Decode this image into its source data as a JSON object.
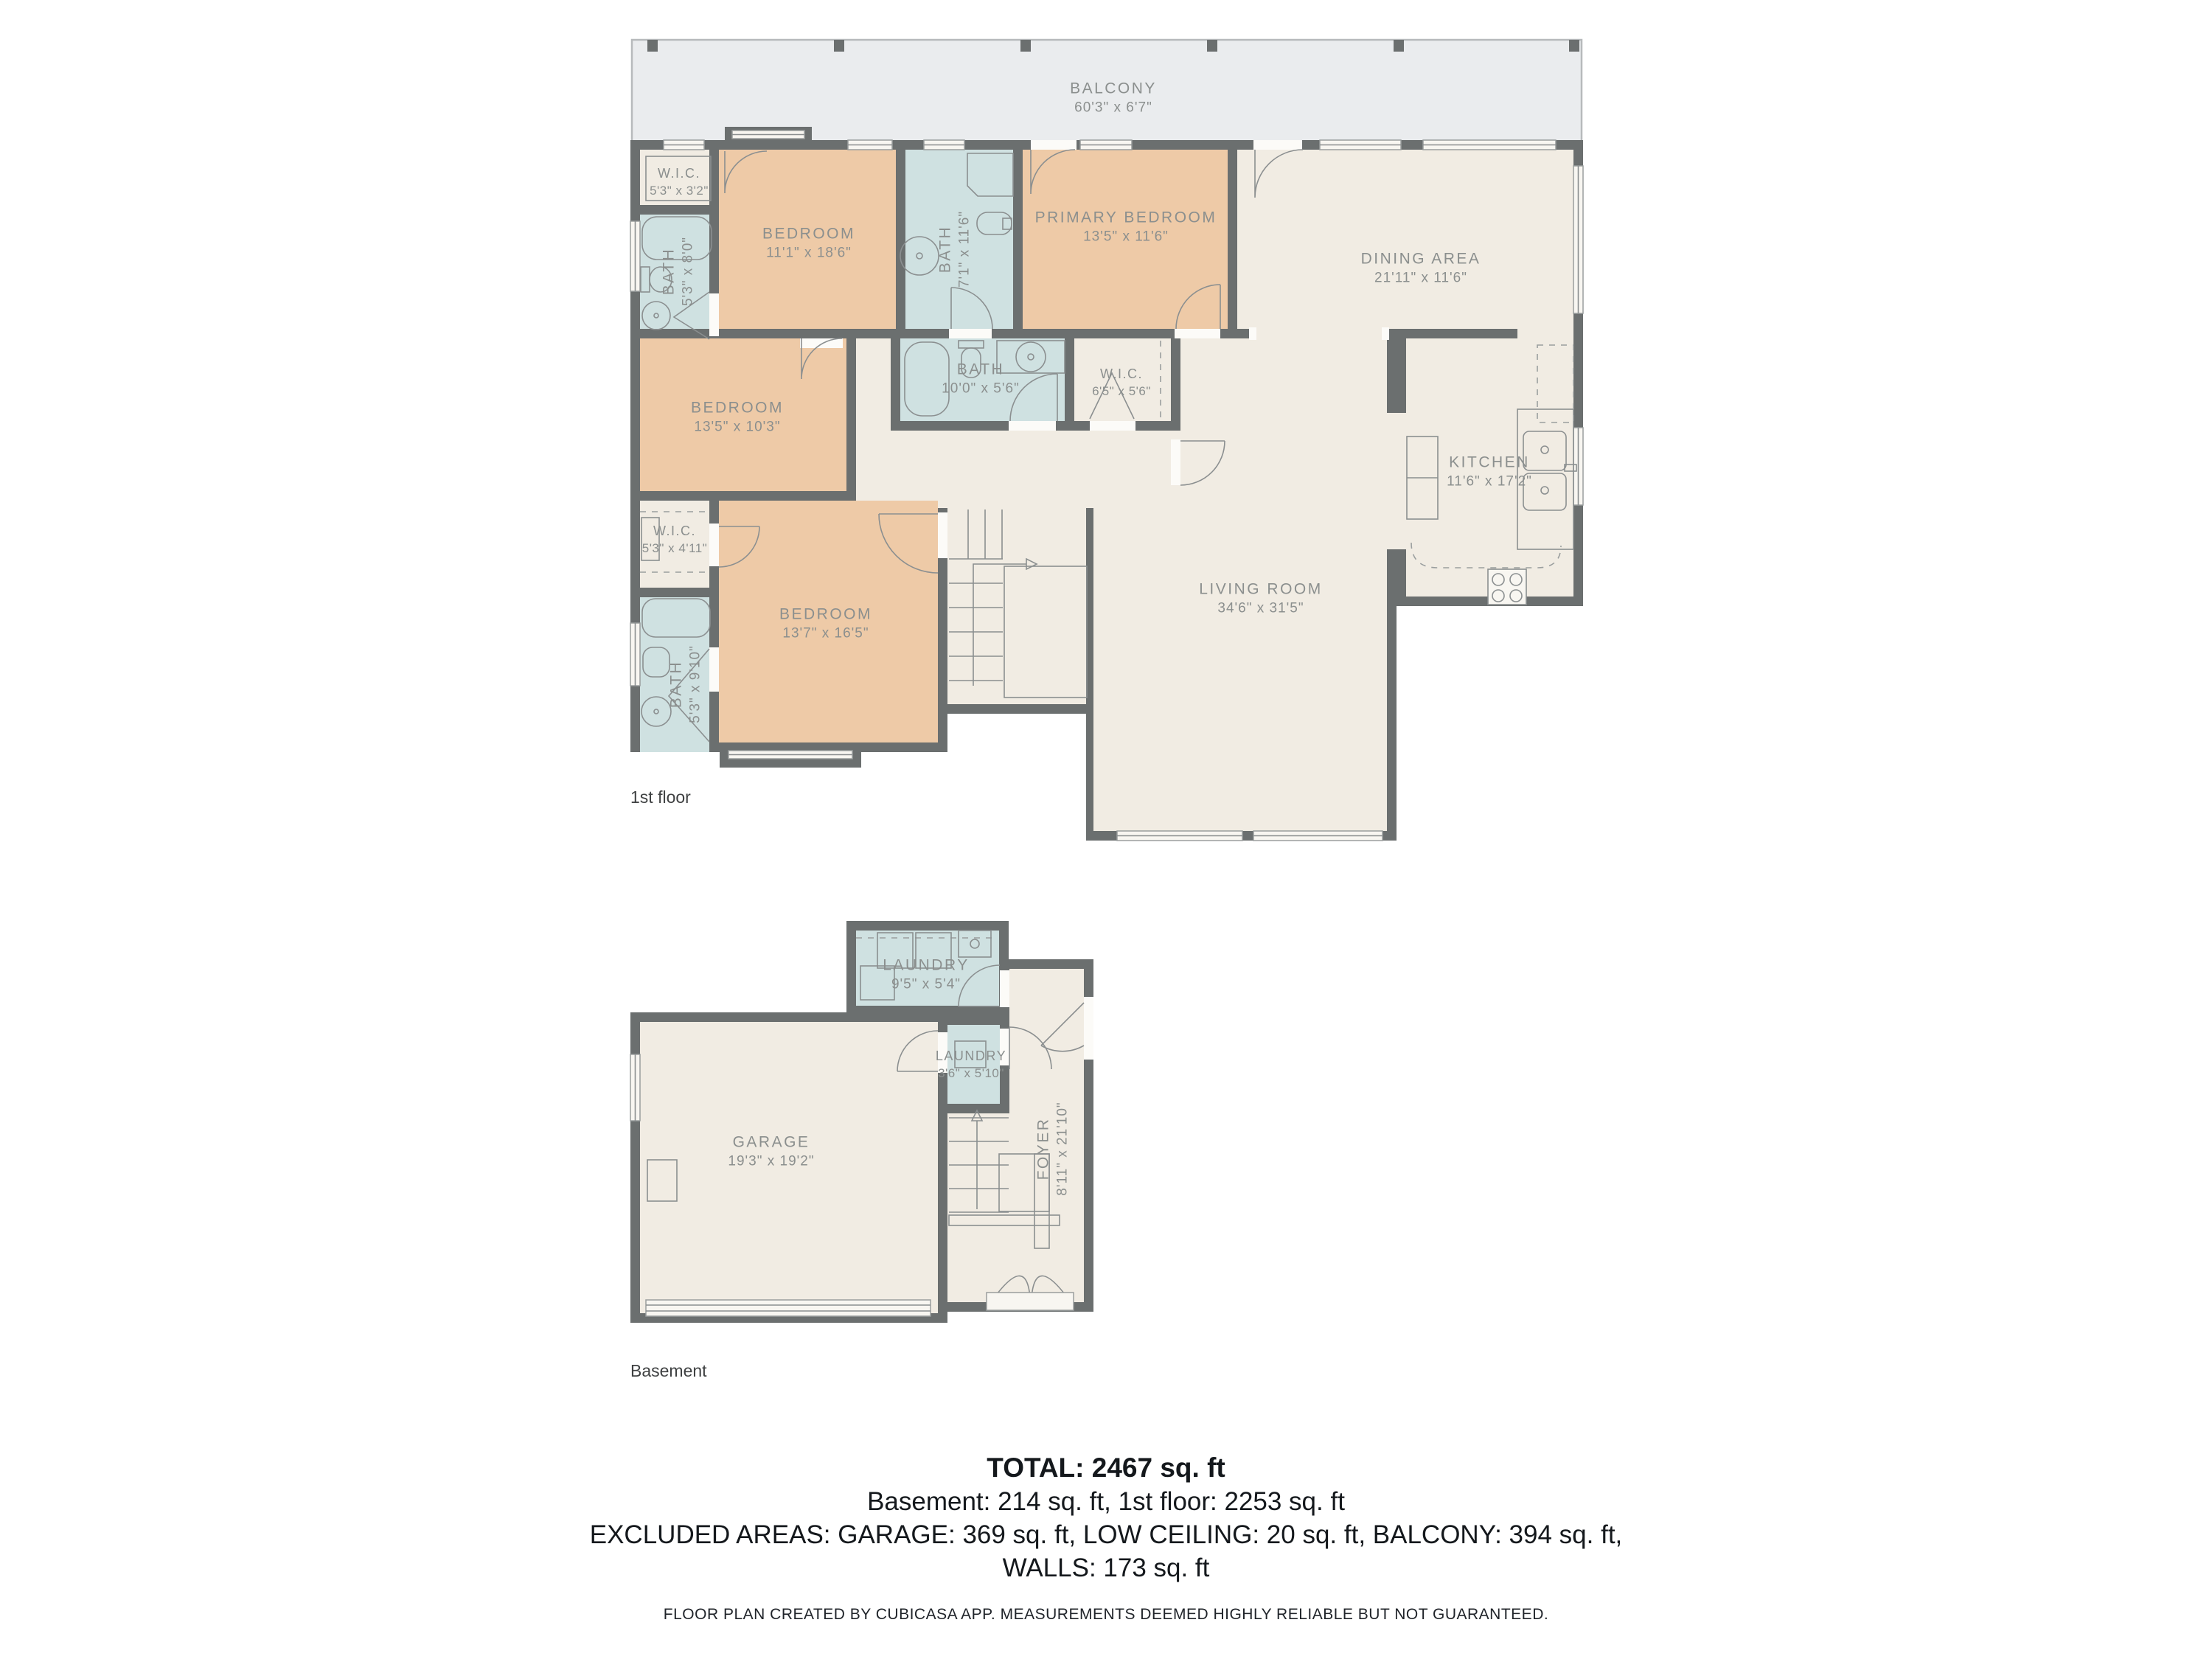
{
  "palette": {
    "wall": "#6b6f6f",
    "bedroom_fill": "#eecaa7",
    "wet_room_fill": "#cfe1e1",
    "common_fill": "#f1ece3",
    "balcony_fill": "#eaecee",
    "label_text": "#8b8f8e",
    "summary_text": "#14181c"
  },
  "floor1": {
    "tag": "1st floor",
    "rooms": [
      {
        "name": "BALCONY",
        "dims": "60'3\" x 6'7\""
      },
      {
        "name": "W.I.C.",
        "dims": "5'3\" x 3'2\""
      },
      {
        "name": "BATH",
        "dims": "5'3\" x 8'0\""
      },
      {
        "name": "BEDROOM",
        "dims": "11'1\" x 18'6\""
      },
      {
        "name": "BATH",
        "dims": "7'1\" x 11'6\""
      },
      {
        "name": "PRIMARY BEDROOM",
        "dims": "13'5\" x 11'6\""
      },
      {
        "name": "DINING AREA",
        "dims": "21'11\" x 11'6\""
      },
      {
        "name": "BATH",
        "dims": "10'0\" x 5'6\""
      },
      {
        "name": "W.I.C.",
        "dims": "6'5\" x 5'6\""
      },
      {
        "name": "BEDROOM",
        "dims": "13'5\" x 10'3\""
      },
      {
        "name": "KITCHEN",
        "dims": "11'6\" x 17'2\""
      },
      {
        "name": "W.I.C.",
        "dims": "5'3\" x 4'11\""
      },
      {
        "name": "BEDROOM",
        "dims": "13'7\" x 16'5\""
      },
      {
        "name": "BATH",
        "dims": "5'3\" x 9'10\""
      },
      {
        "name": "LIVING ROOM",
        "dims": "34'6\" x 31'5\""
      }
    ]
  },
  "basement": {
    "tag": "Basement",
    "rooms": [
      {
        "name": "LAUNDRY",
        "dims": "9'5\" x 5'4\""
      },
      {
        "name": "LAUNDRY",
        "dims": "3'6\" x 5'10\""
      },
      {
        "name": "GARAGE",
        "dims": "19'3\" x 19'2\""
      },
      {
        "name": "FOYER",
        "dims": "8'11\" x 21'10\""
      }
    ]
  },
  "summary": {
    "total": "TOTAL: 2467 sq. ft",
    "floors": "Basement: 214 sq. ft, 1st floor: 2253 sq. ft",
    "excluded": "EXCLUDED AREAS: GARAGE: 369 sq. ft, LOW CEILING: 20 sq. ft, BALCONY: 394 sq. ft,",
    "walls": "WALLS: 173 sq. ft",
    "footer": "FLOOR PLAN CREATED BY CUBICASA APP. MEASUREMENTS DEEMED HIGHLY RELIABLE BUT NOT GUARANTEED."
  }
}
